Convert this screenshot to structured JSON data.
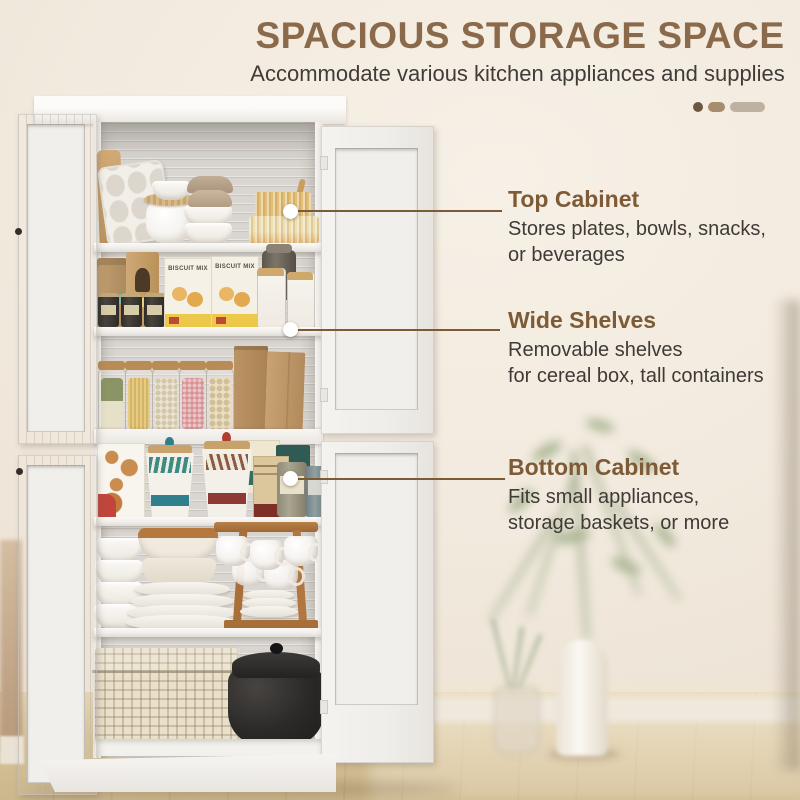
{
  "header": {
    "title": "SPACIOUS STORAGE SPACE",
    "subtitle": "Accommodate various kitchen appliances and supplies"
  },
  "carousel_indicator": {
    "shapes": [
      "dot",
      "short-rounded-bar",
      "long-rounded-bar"
    ],
    "colors": [
      "#6d5640",
      "#a68d6e",
      "#beb1a1"
    ]
  },
  "callouts": [
    {
      "title": "Top Cabinet",
      "body_lines": [
        "Stores plates, bowls, snacks,",
        "or beverages"
      ]
    },
    {
      "title": "Wide Shelves",
      "body_lines": [
        "Removable shelves",
        "for cereal box, tall containers"
      ]
    },
    {
      "title": "Bottom Cabinet",
      "body_lines": [
        "Fits small appliances,",
        "storage baskets, or more"
      ]
    }
  ],
  "photo": {
    "subject": "white 4-door kitchen pantry cabinet with doors open",
    "biscuit_box_label": "BISCUIT MIX",
    "shelves": {
      "top": [
        "muffin tray",
        "cutting board",
        "straw-lid jar",
        "white bowl stack",
        "taupe bowl stack",
        "ribbed bamboo boxes"
      ],
      "second": [
        "kraft bags",
        "spice tins",
        "biscuit mix boxes",
        "flour jars",
        "glass canister"
      ],
      "third": [
        "jar of herbs",
        "jar of spaghetti",
        "jar of oats",
        "jar of pink candy",
        "jar of shell pasta",
        "paper bags"
      ],
      "fourth": [
        "cookie box",
        "teal canister",
        "red canister",
        "cracker box",
        "storage tins",
        "cereal box"
      ],
      "fifth": [
        "white bowl stack",
        "brown glazed bowls",
        "plate stack",
        "wooden mug rack with cups",
        "small plates"
      ],
      "bottom": [
        "woven storage basket",
        "black dutch oven pot"
      ]
    },
    "background": [
      "beige wall",
      "wood floor",
      "white vase with green plant",
      "small glass vase with sprigs"
    ]
  },
  "colors": {
    "title_brown": "#8a6a4a",
    "callout_brown": "#7d5b36",
    "leader_line": "#7b5b35",
    "body_text": "#3e3b37",
    "background": "#f1e9dd"
  }
}
